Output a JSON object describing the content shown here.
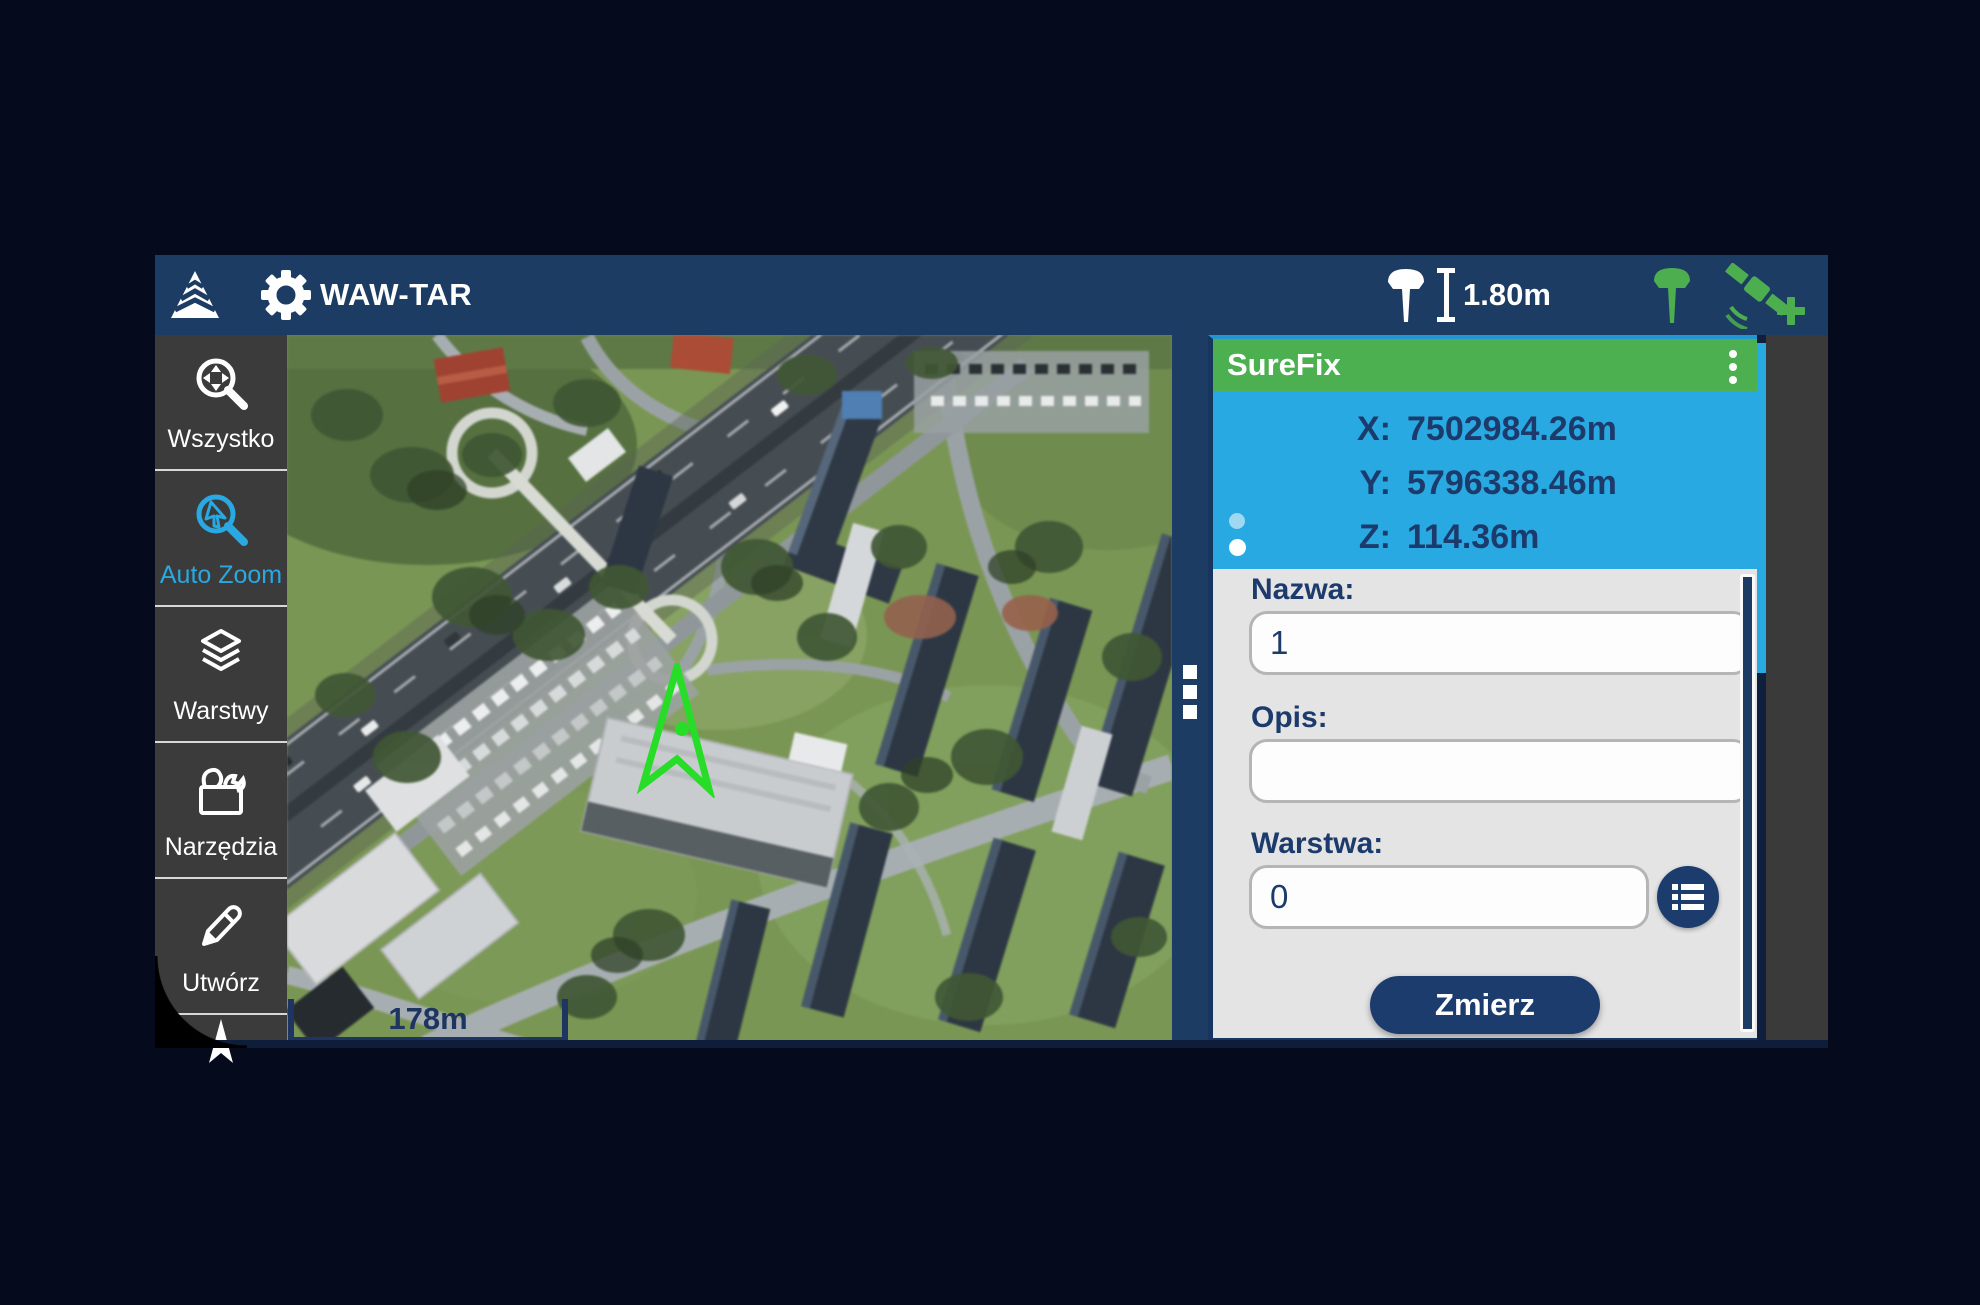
{
  "topbar": {
    "title": "WAW-TAR",
    "antenna_height": "1.80m"
  },
  "sidebar": {
    "items": [
      {
        "label": "Wszystko",
        "icon": "zoom-all-icon",
        "active": false
      },
      {
        "label": "Auto Zoom",
        "icon": "auto-zoom-icon",
        "active": true
      },
      {
        "label": "Warstwy",
        "icon": "layers-icon",
        "active": false
      },
      {
        "label": "Narzędzia",
        "icon": "toolbox-icon",
        "active": false
      },
      {
        "label": "Utwórz",
        "icon": "pencil-icon",
        "active": false
      }
    ]
  },
  "map": {
    "scale_label": "178m"
  },
  "panel": {
    "title": "SureFix",
    "coordinates": [
      {
        "label": "X:",
        "value": "7502984.26m"
      },
      {
        "label": "Y:",
        "value": "5796338.46m"
      },
      {
        "label": "Z:",
        "value": "114.36m"
      }
    ],
    "form": {
      "name_label": "Nazwa:",
      "name_value": "1",
      "desc_label": "Opis:",
      "desc_value": "",
      "layer_label": "Warstwa:",
      "layer_value": "0",
      "measure_button": "Zmierz"
    }
  },
  "side_tabs": [
    {
      "label": "Zmierz",
      "active": true
    },
    {
      "label": "Wytycz",
      "active": false
    }
  ],
  "colors": {
    "topbar_navy": "#1d3c63",
    "header_green": "#4caf50",
    "coords_cyan": "#29a9e1",
    "navy_text": "#1c3a6b",
    "accent_blue": "#29a9e1",
    "marker_green": "#27dd27",
    "button_navy": "#1d3c6e",
    "sidebar_gray": "#3b3b3b"
  }
}
